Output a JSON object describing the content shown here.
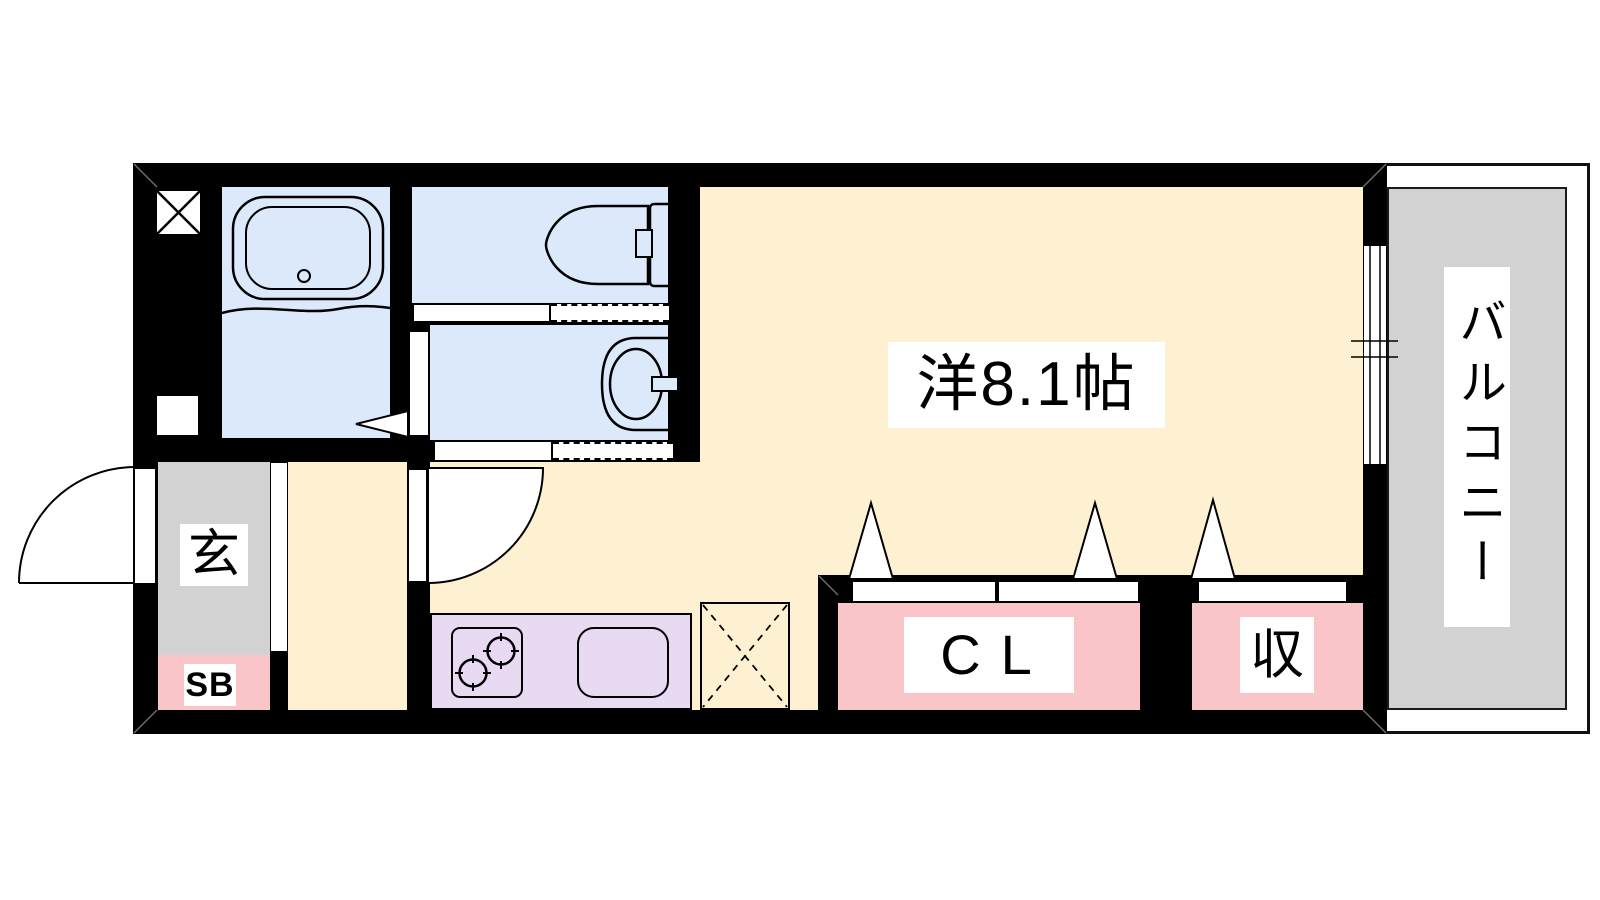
{
  "floorplan": {
    "type": "apartment-floor-plan",
    "wall_color": "#000000",
    "background_color": "#ffffff",
    "rooms": {
      "western_room": {
        "label": "洋8.1帖",
        "color": "#fdf1d1"
      },
      "balcony": {
        "label": "バルコニー",
        "color": "#d2d2d2"
      },
      "entrance": {
        "label": "玄",
        "color": "#d2d2d2"
      },
      "shoe_box": {
        "label": "SB",
        "color": "#fac5c8"
      },
      "closet": {
        "label": "CL",
        "color": "#fac5c8"
      },
      "storage": {
        "label": "収",
        "color": "#fac5c8"
      },
      "bathroom": {
        "color": "#dbe9fb"
      },
      "toilet_room": {
        "color": "#dbe9fb"
      },
      "washroom": {
        "color": "#dbe9fb"
      },
      "kitchen": {
        "color": "#e7daf2"
      }
    },
    "icons": [
      "bathtub-icon",
      "toilet-icon",
      "washbasin-icon",
      "stove-icon",
      "sink-icon",
      "refrigerator-space-icon",
      "pipe-shaft-icon",
      "door-swing-icon",
      "sliding-door-icon",
      "folding-door-icon",
      "window-icon"
    ]
  }
}
